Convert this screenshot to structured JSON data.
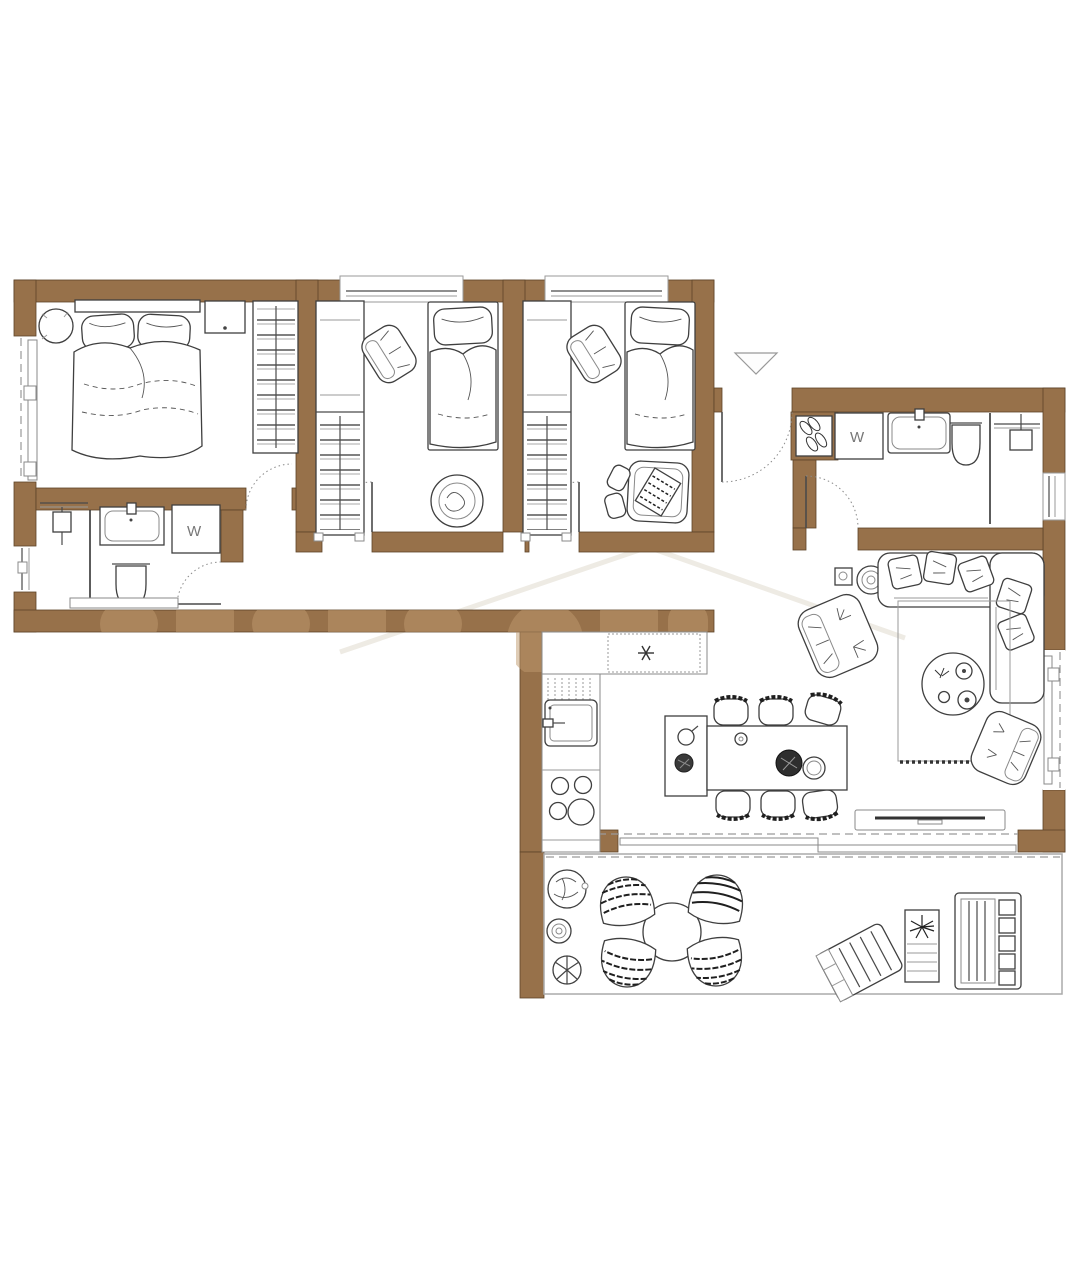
{
  "document": {
    "type": "apartment floor plan",
    "view": "top-down architectural drawing"
  },
  "colors": {
    "wall": "#97714a",
    "wall_edge": "#5d4428",
    "watermark_letters": "#c09a6e",
    "watermark_roof": "#eeebe4",
    "line": "#4a4a4a",
    "line_light": "#9a9a9a",
    "background": "#ffffff"
  },
  "labels": {
    "washer_left": "W",
    "washer_right": "W"
  },
  "symbols": {
    "cooktop_symbol": "asterisk / hob symbol",
    "entrance_arrow": "triangle pointing down at front door"
  },
  "rooms": [
    {
      "name": "master-bedroom",
      "furniture": [
        "double-bed",
        "two-pillows",
        "duvet",
        "nightstand",
        "round-side-table",
        "wardrobe-with-rails"
      ],
      "openings": [
        "left-wall-window",
        "door-to-hallway"
      ]
    },
    {
      "name": "kids-bedroom-1",
      "furniture": [
        "single-bed",
        "tall-wardrobe",
        "armchair",
        "round-bassinet"
      ],
      "openings": [
        "top-wall-window",
        "door-to-hallway"
      ]
    },
    {
      "name": "kids-bedroom-2",
      "furniture": [
        "single-bed",
        "tall-wardrobe",
        "armchair",
        "play-mat",
        "cushions"
      ],
      "openings": [
        "top-wall-window",
        "door-to-hallway"
      ]
    },
    {
      "name": "bathroom-1",
      "furniture": [
        "shower",
        "glass-partition",
        "sink",
        "toilet",
        "washing-machine-W",
        "low-shelf"
      ],
      "openings": [
        "left-wall-window",
        "door-to-hallway"
      ]
    },
    {
      "name": "hallway",
      "furniture": []
    },
    {
      "name": "entry-hall",
      "furniture": [
        "shoe-cabinet"
      ],
      "openings": [
        "front-door-with-arrow"
      ]
    },
    {
      "name": "bathroom-2",
      "furniture": [
        "washing-machine-W",
        "sink",
        "toilet",
        "shower",
        "glass-partition"
      ],
      "openings": [
        "right-wall-window",
        "door-to-living-area"
      ]
    },
    {
      "name": "kitchen",
      "furniture": [
        "l-shaped-counter",
        "hob-symbol",
        "dishwasher-dotted",
        "kitchen-sink",
        "cooktop-4-burners",
        "island-sideboard",
        "kettle",
        "plant"
      ],
      "openings": []
    },
    {
      "name": "dining-area",
      "furniture": [
        "dining-table",
        "six-chairs",
        "cup",
        "fruit-bowl",
        "plate"
      ],
      "openings": []
    },
    {
      "name": "living-room",
      "furniture": [
        "corner-sofa",
        "sofa-cushions",
        "armchair-1",
        "armchair-2",
        "round-coffee-table",
        "rug-with-fringe",
        "tv-sideboard",
        "planter-square",
        "plant-round"
      ],
      "openings": [
        "right-wall-window",
        "sliding-door-to-terrace"
      ]
    },
    {
      "name": "terrace",
      "furniture": [
        "round-table",
        "four-wicker-chairs",
        "three-potted-plants",
        "sun-lounger",
        "planter-box-with-plant",
        "garden-bench-with-cushions"
      ],
      "openings": []
    }
  ],
  "watermark": {
    "letter_band_on_bottom_wall": true,
    "roof_outline_faint": true
  }
}
